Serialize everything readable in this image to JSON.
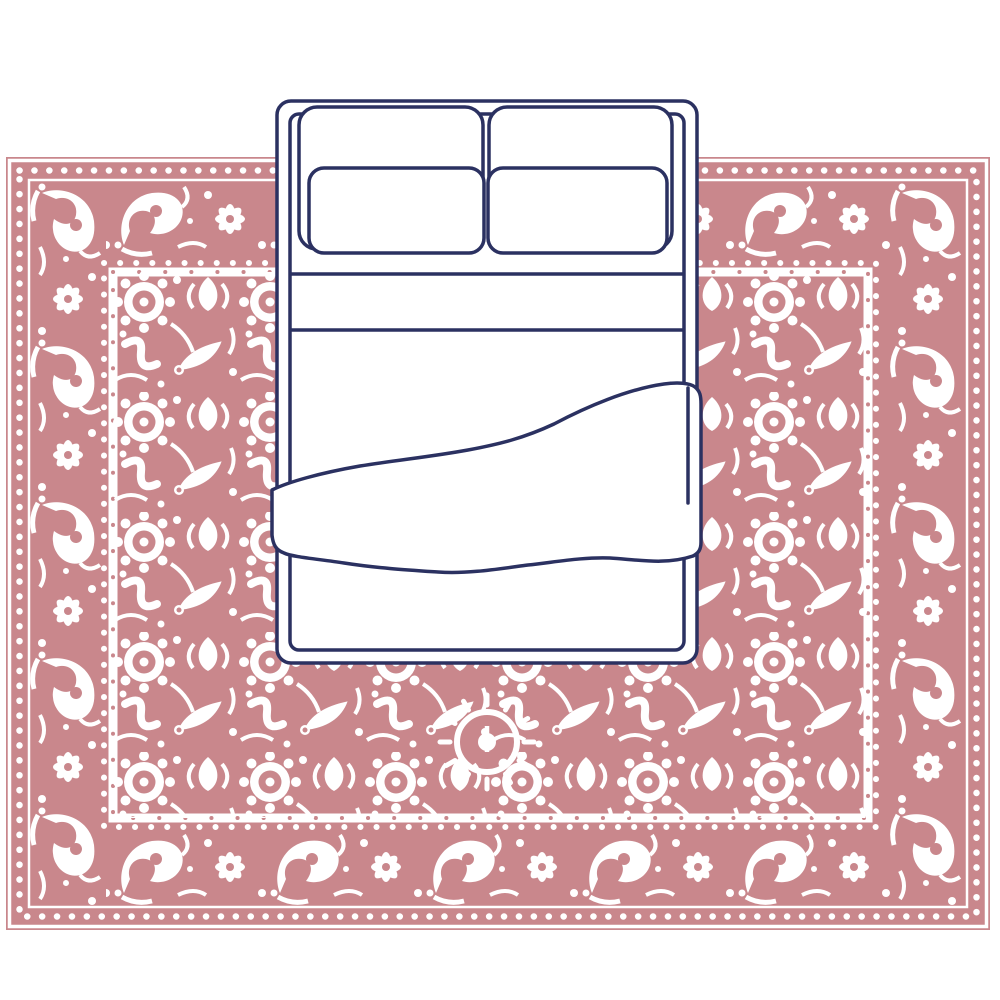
{
  "scene": {
    "description": "Top-down illustration of a double bed with four pillows, a folded sheet band and a draped duvet, placed on a large ornate rose-pink Persian-style area rug on a white floor",
    "colors": {
      "page_background": "#ffffff",
      "rug_pink": "#c9878c",
      "rug_pattern_white": "#ffffff",
      "bed_outline_navy": "#2b3161",
      "bed_fill_white": "#ffffff"
    },
    "elements": [
      {
        "name": "area-rug",
        "label": "Ornate rose area rug (top view)"
      },
      {
        "name": "double-bed",
        "label": "Double bed with pillows and duvet (top view)"
      }
    ]
  }
}
